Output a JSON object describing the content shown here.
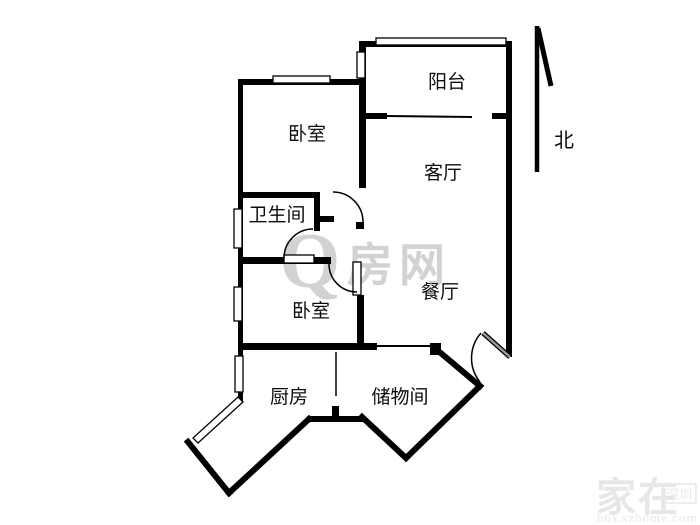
{
  "plan": {
    "type": "apartment-floor-plan",
    "rooms": {
      "bedroom1": "卧室",
      "balcony": "阳台",
      "living": "客厅",
      "bathroom": "卫生间",
      "dining": "餐厅",
      "bedroom2": "卧室",
      "kitchen": "厨房",
      "storage": "储物间"
    },
    "compass": {
      "label": "北"
    }
  },
  "watermark_center": {
    "q": "Q",
    "text": "房网"
  },
  "watermark_corner": {
    "brand": "家在",
    "badge": "深圳",
    "url": "bbs.szhome.com"
  },
  "colors": {
    "wall": "#000000",
    "label": "#0d0d0d",
    "watermark_center": "#c7c7c7",
    "watermark_corner": "#e7e7e7",
    "door_leaf_gray": "#9a9a9a",
    "background": "#ffffff"
  }
}
